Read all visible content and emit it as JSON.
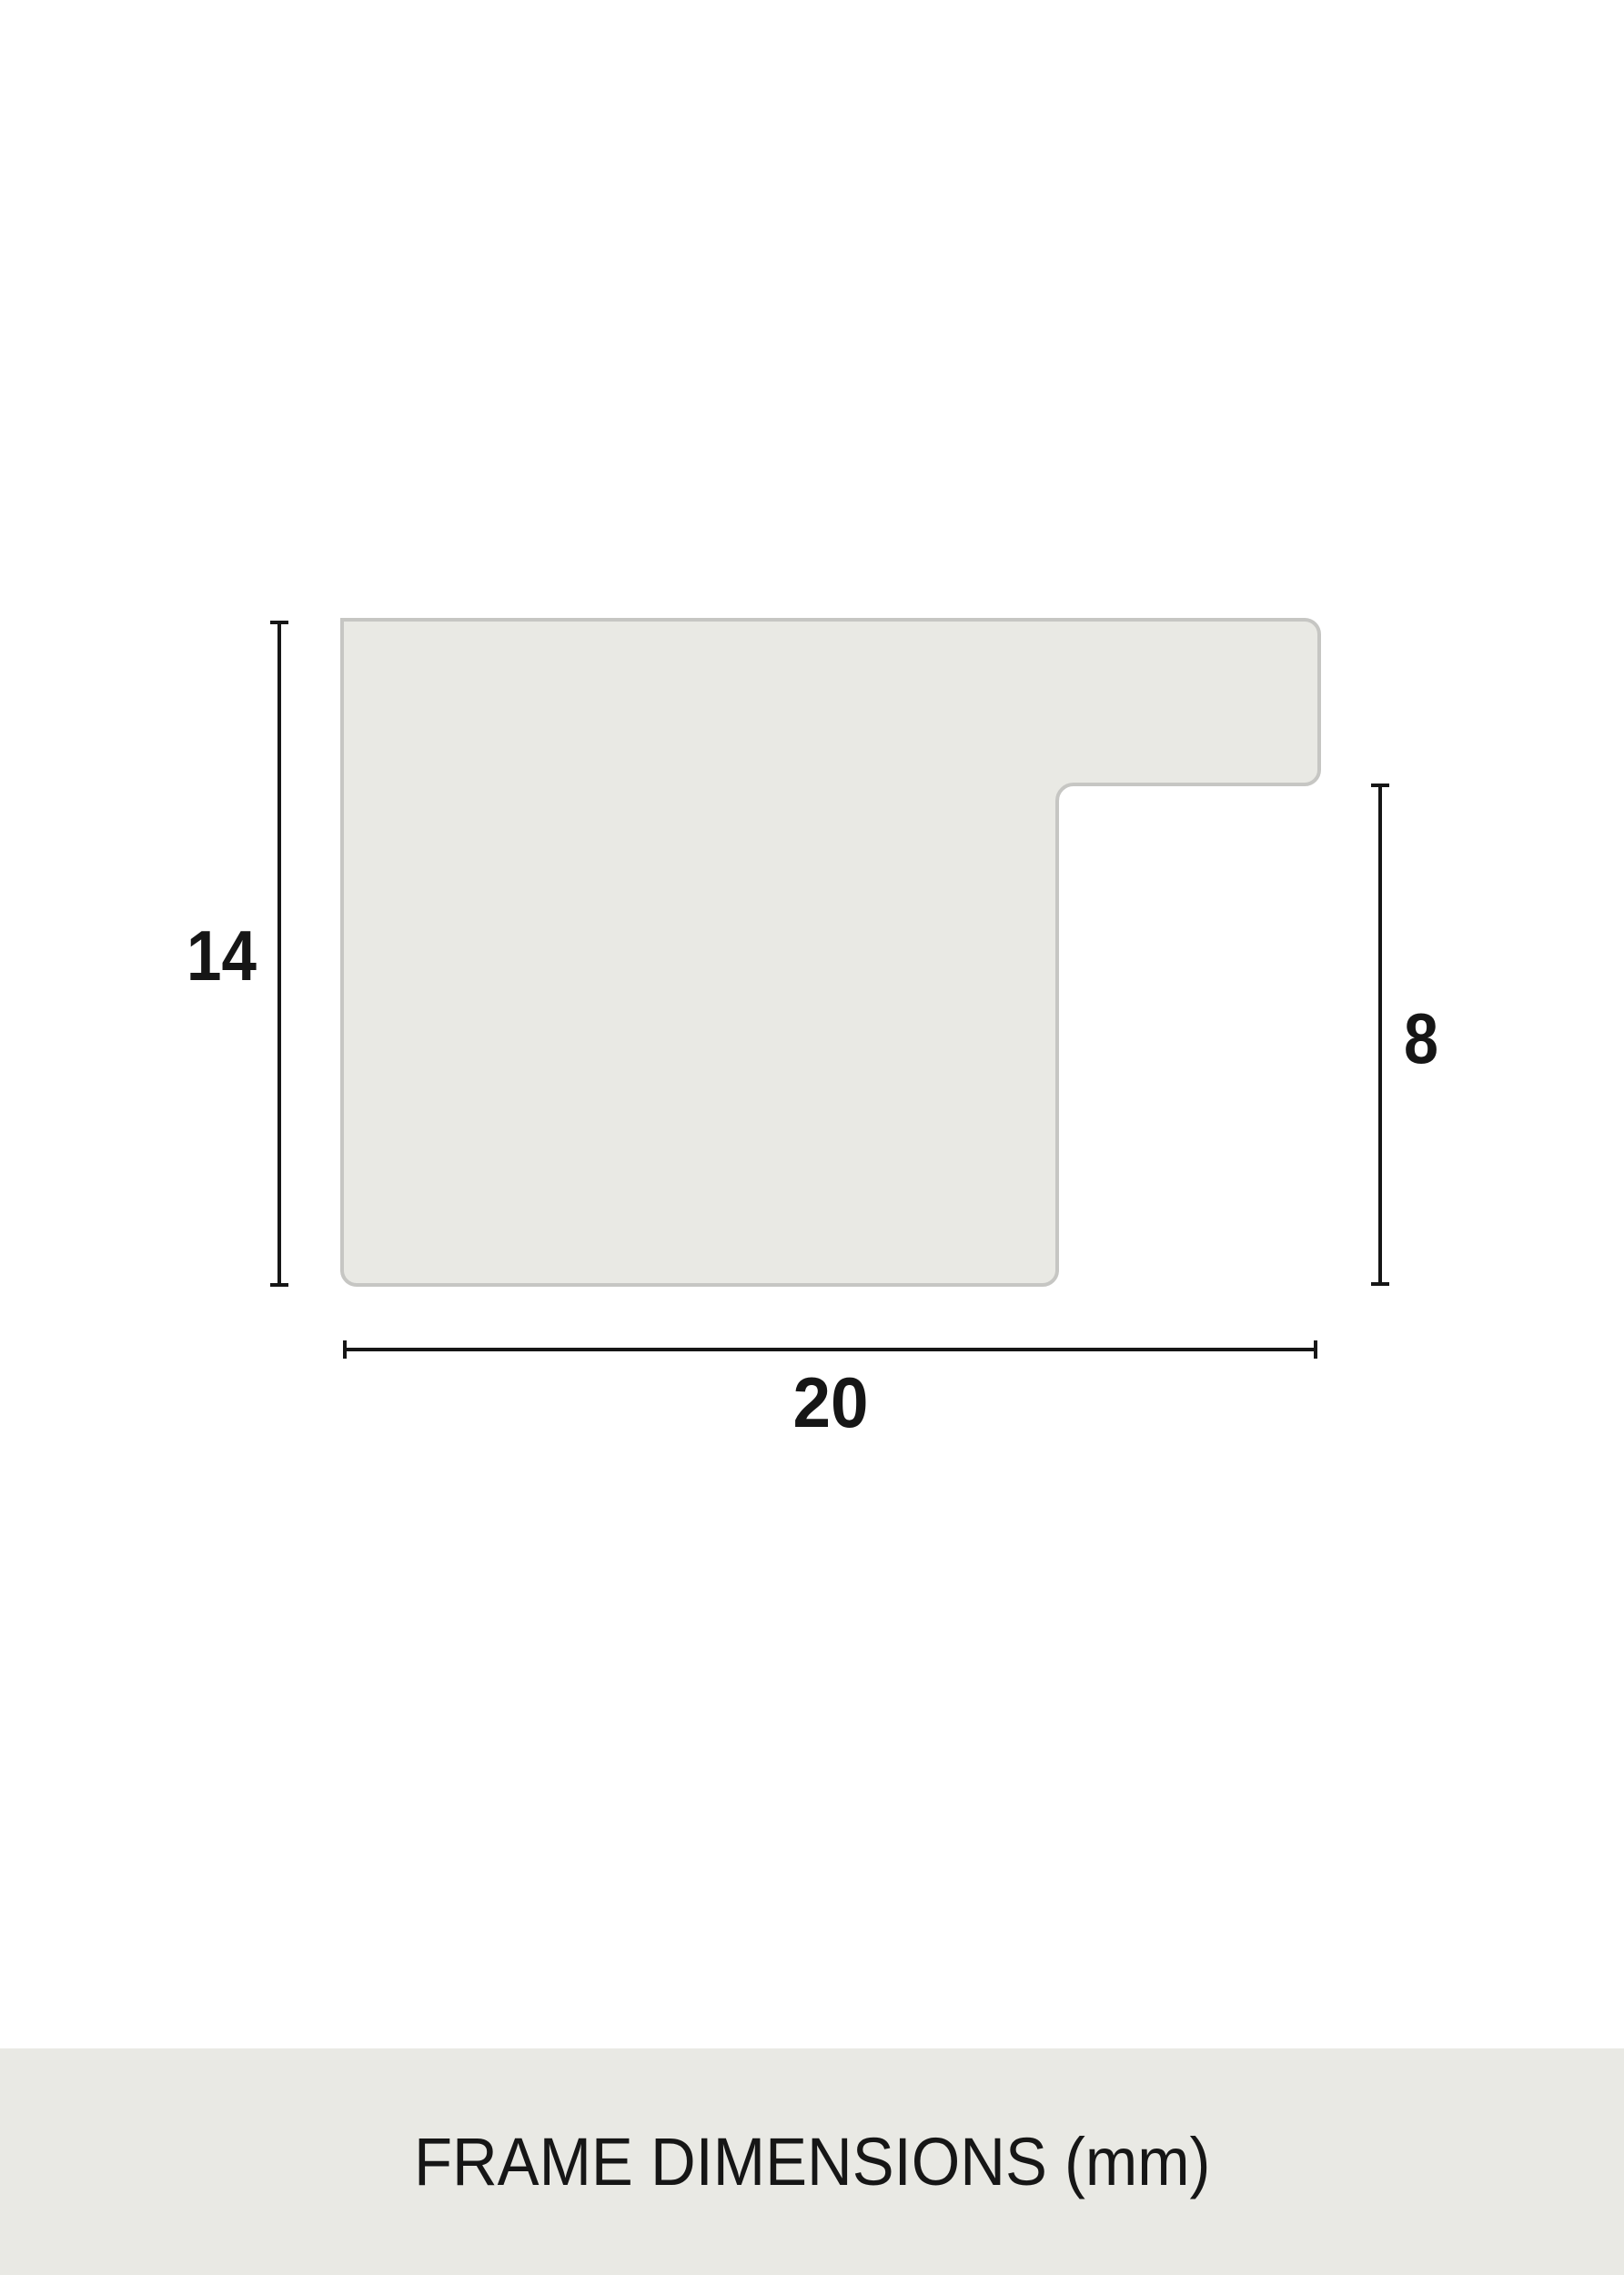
{
  "colors": {
    "pageBg": "#ffffff",
    "shapeFill": "#e9e9e4",
    "shapeStroke": "#c6c6c3",
    "lineColor": "#161616",
    "textColor": "#161616",
    "footerBg": "#e9e9e4"
  },
  "dimensions": {
    "height_mm": "14",
    "step_height_mm": "8",
    "width_mm": "20"
  },
  "footer": {
    "label": "FRAME DIMENSIONS (mm)"
  }
}
